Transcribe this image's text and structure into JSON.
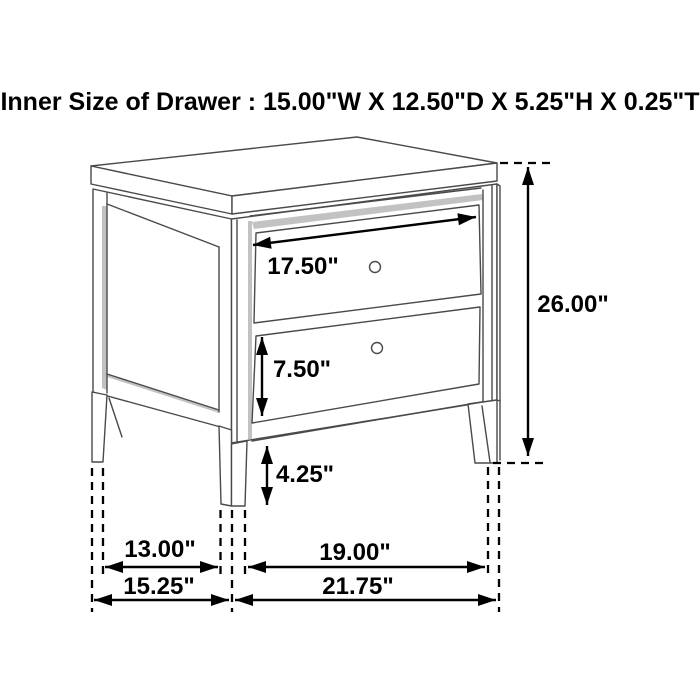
{
  "title": "Inner Size of Drawer : 15.00\"W X 12.50\"D X 5.25\"H X 0.25\"T",
  "dimensions": {
    "drawer_front_width": "17.50\"",
    "overall_height": "26.00\"",
    "bottom_drawer_front_height": "7.50\"",
    "leg_height": "4.25\"",
    "inner_leg_depth": "13.00\"",
    "inner_leg_width": "19.00\"",
    "overall_depth": "15.25\"",
    "overall_width": "21.75\""
  },
  "colors": {
    "background": "#ffffff",
    "furniture_line": "#4a4a4a",
    "dimension": "#000000",
    "shadow": "#c2c2c2"
  }
}
